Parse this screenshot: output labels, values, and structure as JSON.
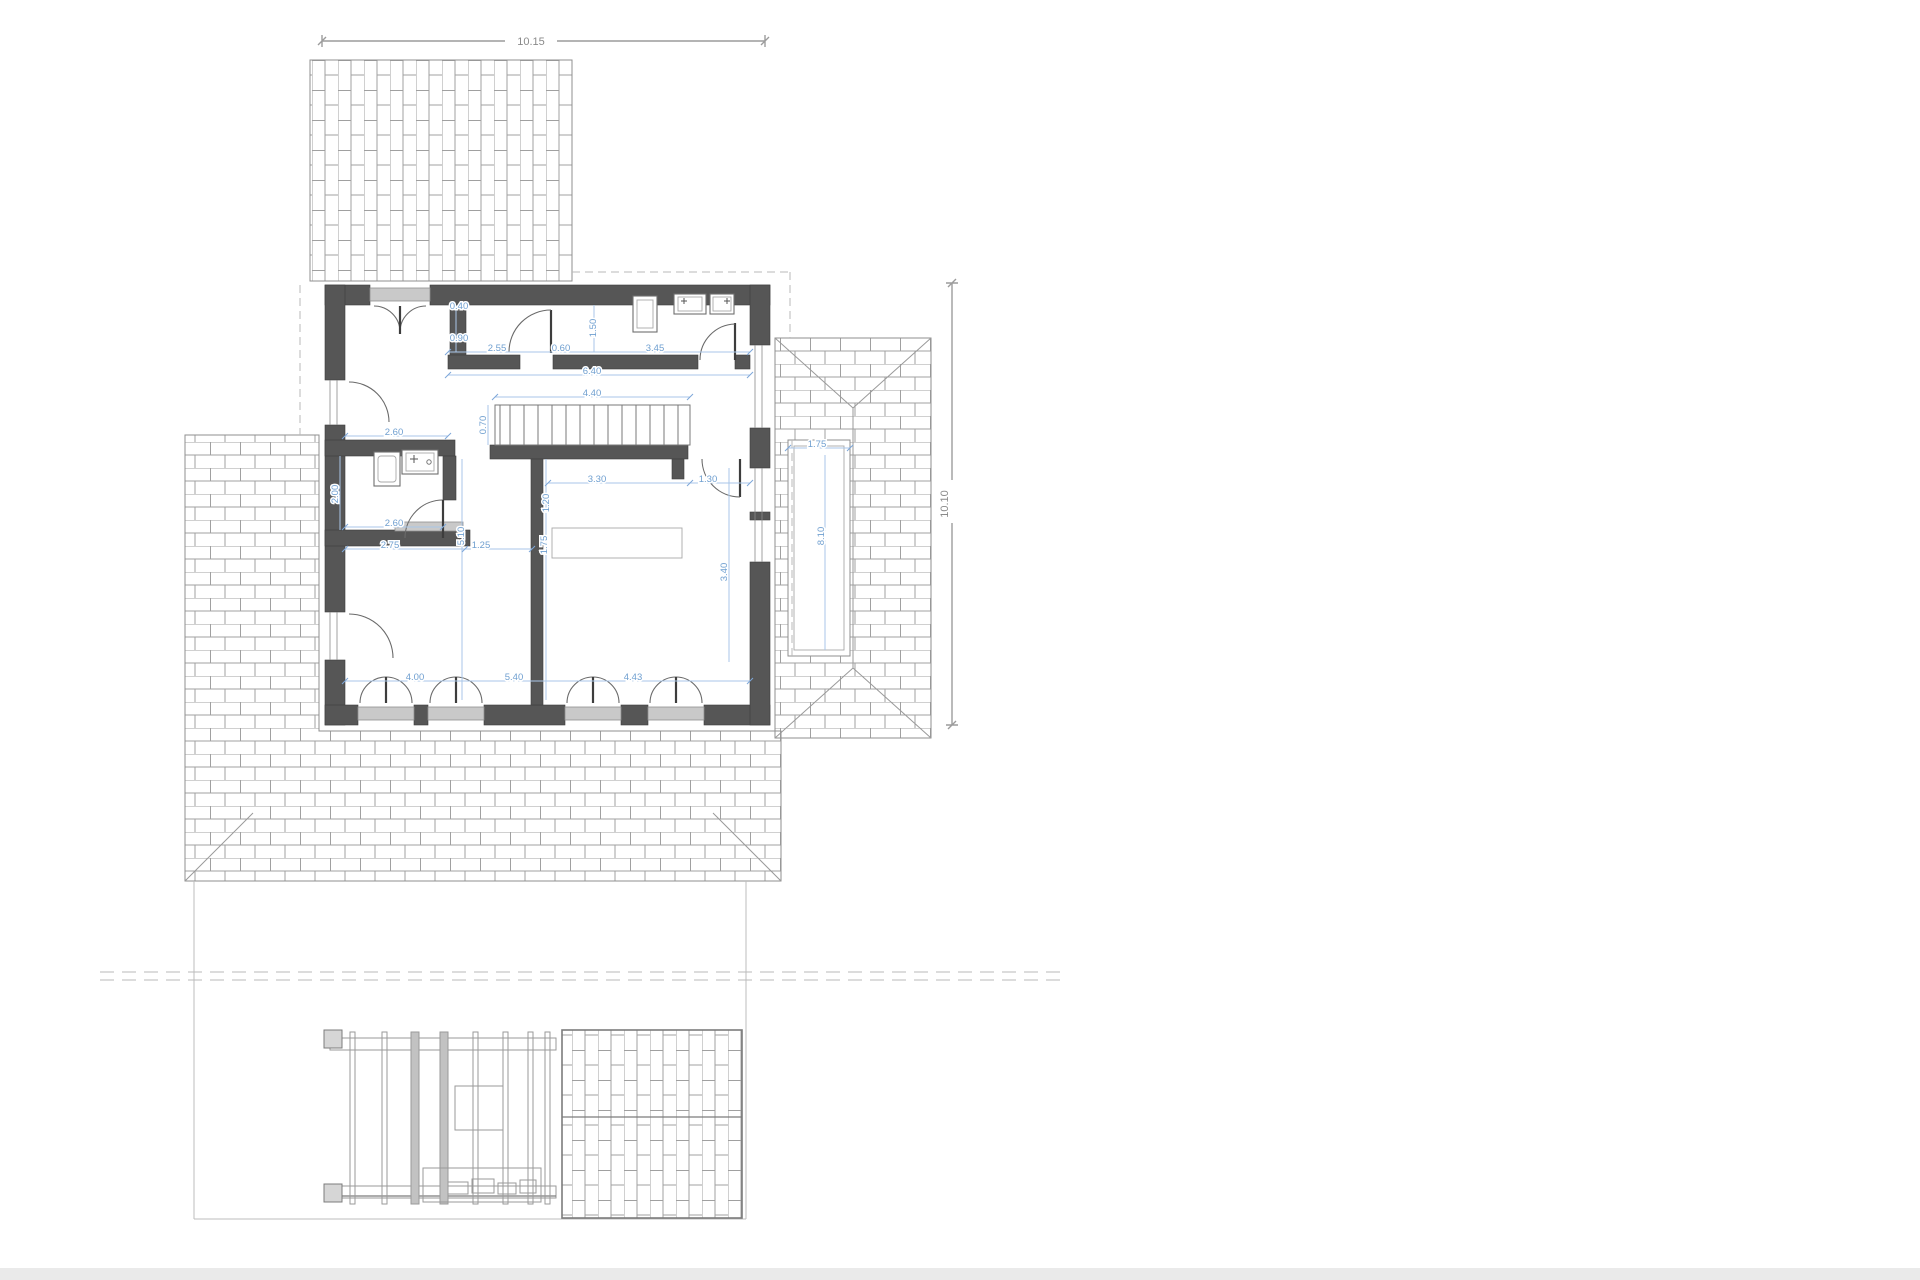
{
  "drawing": {
    "type": "architectural-floor-plan",
    "overall_dimensions": [
      {
        "text": "10.15",
        "x": 531,
        "y": 45,
        "rot": 0
      },
      {
        "text": "10.10",
        "x": 948,
        "y": 504,
        "rot": -90
      }
    ],
    "interior_dimensions": [
      {
        "text": "0.40",
        "x": 459,
        "y": 309,
        "rot": 0
      },
      {
        "text": "0.90",
        "x": 459,
        "y": 341,
        "rot": 0
      },
      {
        "text": "2.55",
        "x": 497,
        "y": 351,
        "rot": 0
      },
      {
        "text": "0.60",
        "x": 561,
        "y": 351,
        "rot": 0
      },
      {
        "text": "3.45",
        "x": 655,
        "y": 351,
        "rot": 0
      },
      {
        "text": "1.50",
        "x": 596,
        "y": 328,
        "rot": -90
      },
      {
        "text": "6.40",
        "x": 592,
        "y": 374,
        "rot": 0
      },
      {
        "text": "4.40",
        "x": 592,
        "y": 396,
        "rot": 0
      },
      {
        "text": "0.70",
        "x": 486,
        "y": 425,
        "rot": -90
      },
      {
        "text": "2.60",
        "x": 394,
        "y": 435,
        "rot": 0
      },
      {
        "text": "2.00",
        "x": 338,
        "y": 494,
        "rot": -90
      },
      {
        "text": "2.60",
        "x": 394,
        "y": 526,
        "rot": 0
      },
      {
        "text": "5.10",
        "x": 464,
        "y": 536,
        "rot": -90
      },
      {
        "text": "2.75",
        "x": 390,
        "y": 548,
        "rot": 0
      },
      {
        "text": "1.25",
        "x": 481,
        "y": 548,
        "rot": 0
      },
      {
        "text": "3.30",
        "x": 597,
        "y": 482,
        "rot": 0
      },
      {
        "text": "1.30",
        "x": 708,
        "y": 482,
        "rot": 0
      },
      {
        "text": "1.20",
        "x": 549,
        "y": 503,
        "rot": -90
      },
      {
        "text": "1.75",
        "x": 547,
        "y": 545,
        "rot": -90
      },
      {
        "text": "3.40",
        "x": 727,
        "y": 572,
        "rot": -90
      },
      {
        "text": "4.00",
        "x": 415,
        "y": 680,
        "rot": 0
      },
      {
        "text": "5.40",
        "x": 514,
        "y": 680,
        "rot": 0
      },
      {
        "text": "4.43",
        "x": 633,
        "y": 680,
        "rot": 0
      },
      {
        "text": "1.75",
        "x": 817,
        "y": 447,
        "rot": 0
      },
      {
        "text": "8.10",
        "x": 824,
        "y": 536,
        "rot": -90
      }
    ],
    "colors": {
      "wall": "#565656",
      "dimension_blue": "#6f9fd0",
      "dimension_gray": "#8a8a8a",
      "hatch_line": "#a0a0a0",
      "sill": "#c9c9c9",
      "roof_outline": "#8f8f8f",
      "dashed_line": "#b8b8b8",
      "background": "#ffffff"
    }
  }
}
